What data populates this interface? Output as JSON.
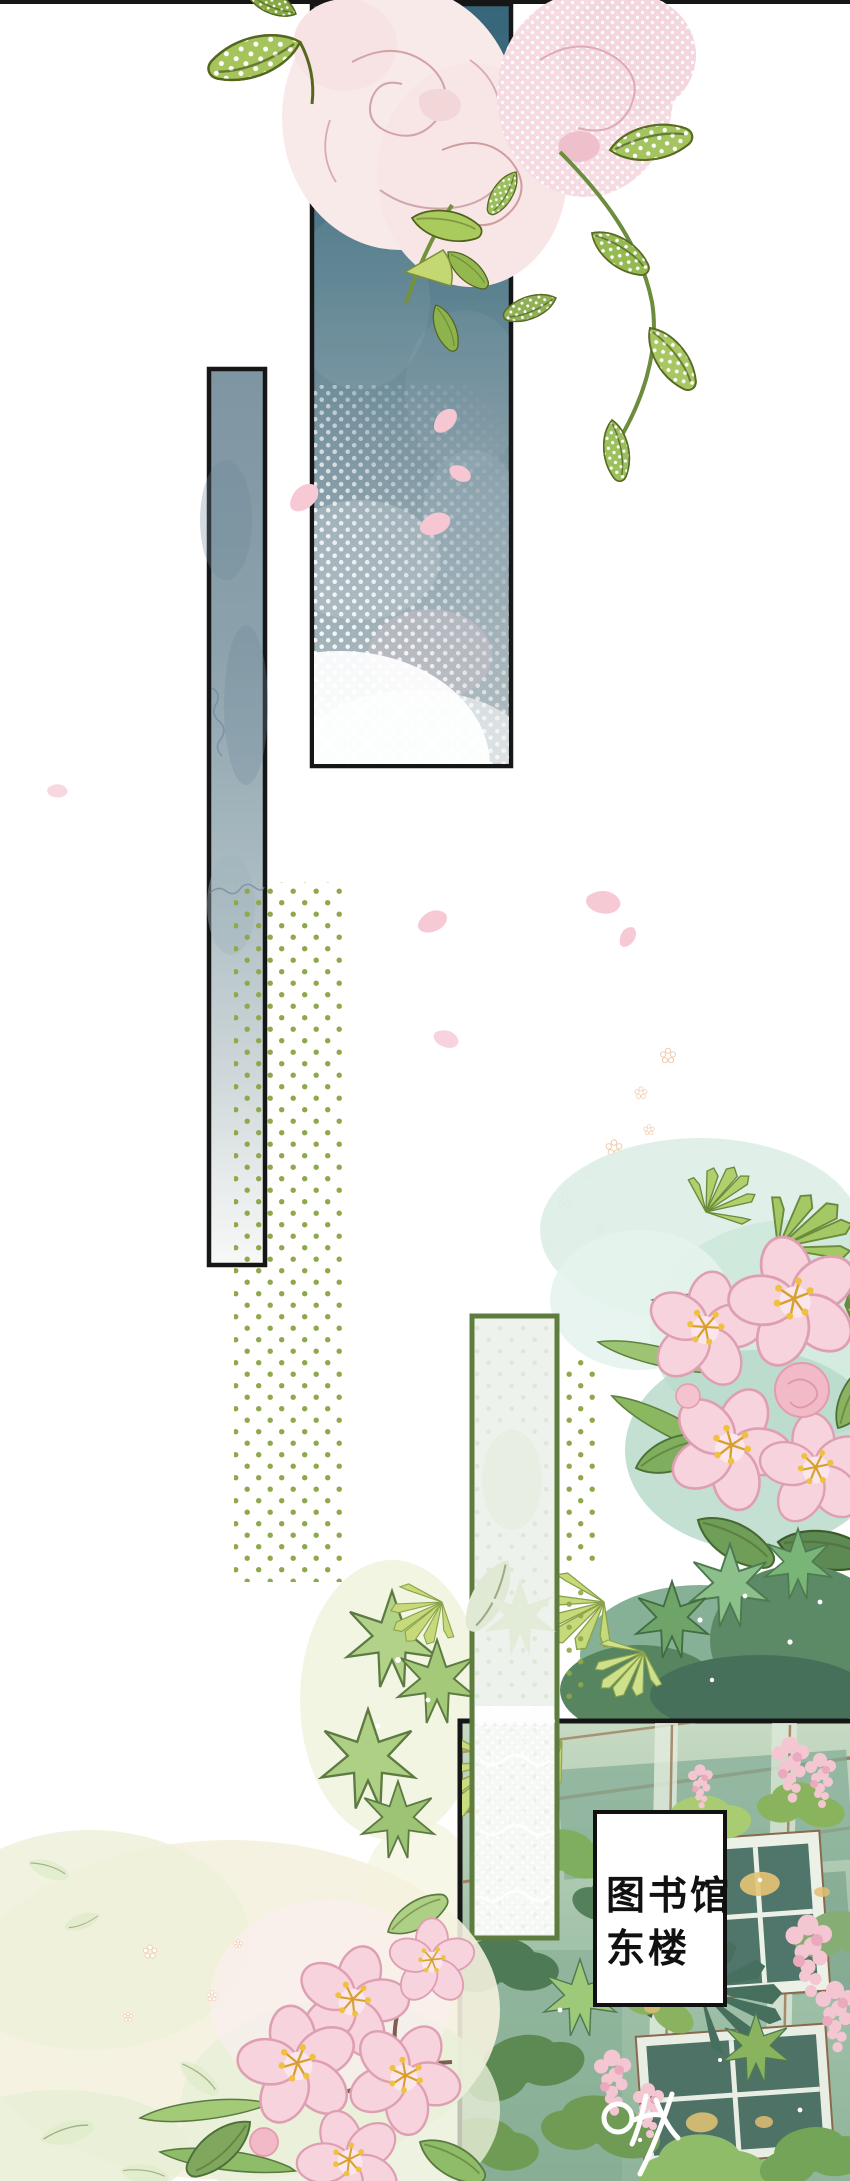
{
  "page": {
    "width": 850,
    "height": 2181,
    "background": "#ffffff"
  },
  "sign_board": {
    "line1": "图书馆",
    "line2": "东楼"
  },
  "colors": {
    "ink_border": "#161616",
    "panel_teal_top": "#38677c",
    "panel_gray_blue": "#7e95a2",
    "halftone_olive": "#8fa84b",
    "green_panel_border": "#5d7c3d",
    "green_panel_fill": "#edf2ec",
    "blossom_pink": "#f6d0da",
    "petal_pink": "#f5c7d3",
    "mint_wash": "#d8ece2",
    "cream_wash": "#f4efdc",
    "photo_green_wall": "#86ad97",
    "wisteria_pink": "#f3c6d2"
  }
}
